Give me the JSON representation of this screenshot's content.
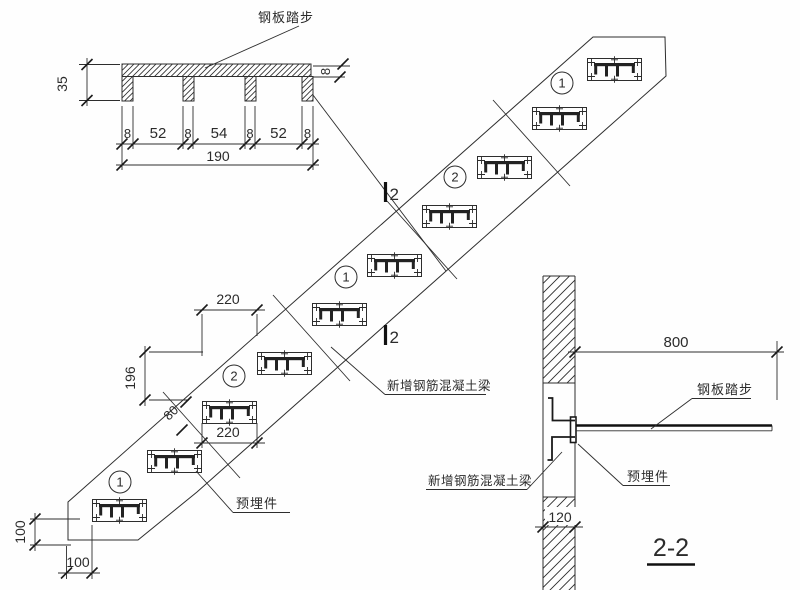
{
  "detail": {
    "label": "钢板踏步",
    "dim_height": "35",
    "dim_thickness": "8",
    "dim_leg": "8",
    "dim_w1": "52",
    "dim_w2": "54",
    "dim_w3": "52",
    "dim_total": "190"
  },
  "plan": {
    "bay_labels": [
      "1",
      "2",
      "1",
      "2",
      "1"
    ],
    "section_label": "2",
    "dim_run_top": "220",
    "dim_rise": "196",
    "dim_beam": "80",
    "dim_run_bottom": "220",
    "dim_end_height": "100",
    "dim_end_width": "100",
    "label_beam": "新增钢筋混凝土梁",
    "label_embed": "预埋件"
  },
  "section": {
    "title": "2-2",
    "dim_length": "800",
    "dim_wall": "120",
    "label_tread": "钢板踏步",
    "label_embed": "预埋件",
    "label_beam": "新增钢筋混凝土梁"
  },
  "colors": {
    "line": "#2d2d2d",
    "background": "#fefefe"
  }
}
